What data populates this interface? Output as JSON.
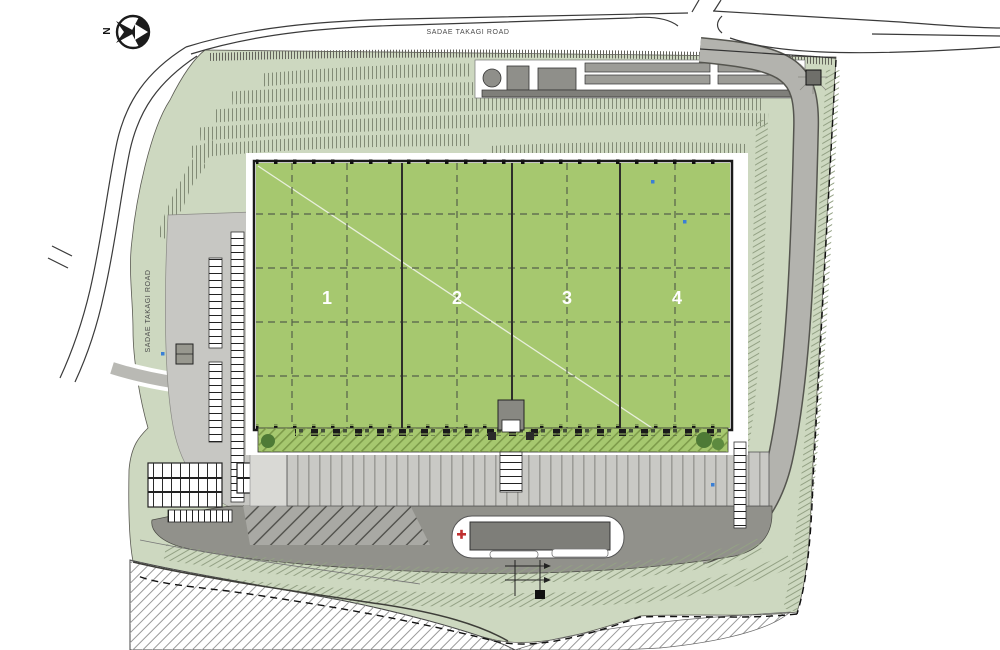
{
  "compass": {
    "north_label": "N"
  },
  "roads": {
    "top_road_label": "SADAE TAKAGI ROAD",
    "left_road_label": "SADAE TAKAGI ROAD"
  },
  "building": {
    "unit_labels": [
      "1",
      "2",
      "3",
      "4"
    ]
  },
  "colors": {
    "roof_green": "#a6c86f",
    "site_green": "#cdd8c0",
    "road_gray": "#a5a5a0",
    "dark_road_gray": "#91918b",
    "apron_gray": "#c9c9c5",
    "line_black": "#1a1a1a",
    "accent_red": "#c03030",
    "marker_blue": "#3a7fd5"
  }
}
